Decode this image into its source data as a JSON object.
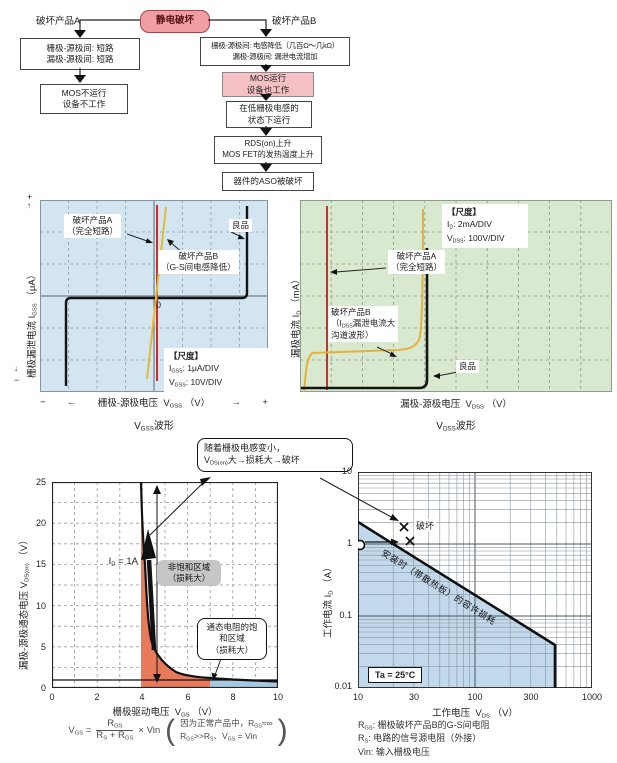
{
  "colors": {
    "panel_blue": "#d2e5f1",
    "panel_green": "#d8e9d0",
    "pink_root": "#f09da4",
    "pink_box": "#f5c0c4",
    "trace_red": "#c9302c",
    "trace_yellow": "#e2bb35",
    "fill_orange": "#e87a5b",
    "fill_blue": "#a6c9e2",
    "aso_blue": "#c2d8eb"
  },
  "fc": {
    "root": "静电破坏",
    "branch_a": "破坏产品A",
    "branch_b": "破坏产品B",
    "a1l1": "栅极-源极间: 短路",
    "a1l2": "漏极-源极间: 短路",
    "a2l1": "MOS不运行",
    "a2l2": "设备不工作",
    "b1l1": "栅极-源极间: 电感降低（几百Ω～几kΩ）",
    "b1l2": "漏极-源极间: 漏泄电流增加",
    "b2l1": "MOS运行",
    "b2l2": "设备也工作",
    "b3l1": "在低栅极电感的",
    "b3l2": "状态下运行",
    "b4l1": "RDS(on)上升",
    "b4l2": "MOS FET的发热温度上升",
    "b5": "器件的ASO被破坏"
  },
  "gss": {
    "plus": "+",
    "minus": "−",
    "up": "↑",
    "down": "↓",
    "larr": "←",
    "rarr": "→",
    "ylabel": "栅极漏泄电流 ",
    "ysym": "I",
    "ysub": "GSS",
    "yunit": "（μA）",
    "label_a1": "破坏产品A",
    "label_a2": "（完全短路）",
    "label_b1": "破坏产品B",
    "label_b2": "（G-S间电感降低）",
    "good": "良品",
    "zero": "0",
    "scale_title": "【尺度】",
    "s1sym": "I",
    "s1sub": "GSS",
    "s1val": ": 1μA/DIV",
    "s2sym": "V",
    "s2sub": "GSS",
    "s2val": ": 10V/DIV",
    "xlabel": "栅极-源极电压",
    "xsym": "V",
    "xsub": "GSS",
    "xunit": "（V）",
    "capsym": "V",
    "capsub": "GSS",
    "captail": "波形"
  },
  "dss": {
    "ylabel": "漏极电流 ",
    "ysym": "I",
    "ysub": "D",
    "yunit": "（mA）",
    "scale_title": "【尺度】",
    "s1sym": "I",
    "s1sub": "D",
    "s1val": ": 2mA/DIV",
    "s2sym": "V",
    "s2sub": "DSS",
    "s2val": ": 100V/DIV",
    "label_a1": "破坏产品A",
    "label_a2": "（完全短路）",
    "label_b1": "破坏产品B",
    "label_b2a": "（I",
    "label_b2sub": "DSS",
    "label_b2b": "漏泄电流大",
    "label_b3": "沟道波形）",
    "good": "良品",
    "xlabel": "漏极-源极电压",
    "xsym": "V",
    "xsub": "DSS",
    "xunit": "（V）",
    "capsym": "V",
    "capsub": "DSS",
    "captail": "波形"
  },
  "callout": {
    "l1": "随着栅极电感变小，",
    "l2a": "V",
    "l2sub": "DS(on)",
    "l2b": "大→损耗大→破坏"
  },
  "vgs": {
    "yticks": [
      "25",
      "20",
      "15",
      "10",
      "5",
      "0"
    ],
    "xticks": [
      "0",
      "2",
      "4",
      "6",
      "8",
      "10"
    ],
    "ylabel": "漏极-源极通态电压 ",
    "ysym": "V",
    "ysub": "DS(on)",
    "yunit": "（V）",
    "xlabel": "栅极驱动电压",
    "xsym": "V",
    "xsub": "GS",
    "xunit": "（V）",
    "id_sym": "I",
    "id_sub": "D",
    "id_val": " = 1A",
    "r1l1": "非饱和区域",
    "r1l2": "（损耗大）",
    "r2l1": "通态电阻的饱",
    "r2l2": "和区域",
    "r2l3": "（损耗大）"
  },
  "aso": {
    "yticks": [
      "10",
      "1",
      "0.1",
      "0.01"
    ],
    "xticks": [
      "10",
      "30",
      "100",
      "300",
      "1000"
    ],
    "ylabel": "工作电流 ",
    "ysym": "I",
    "ysub": "D",
    "yunit": "（A）",
    "xlabel": "工作电压",
    "xsym": "V",
    "xsub": "DS",
    "xunit": "（V）",
    "destroy": "破坏",
    "diag": "安装时（带散热板）的容许损耗",
    "ta": "Ta = 25°C"
  },
  "formula": {
    "lhs": "V",
    "lhs_sub": "GS",
    "eq": "=",
    "num": "R",
    "num_sub": "GS",
    "den_a": "R",
    "den_a_sub": "S",
    "den_plus": " + ",
    "den_b": "R",
    "den_b_sub": "GS",
    "times": "× Vin",
    "pl": "(",
    "pr": ")",
    "n1a": "因为正常产品中，R",
    "n1sub": "GS",
    "n1b": "≈∞",
    "n2a": "R",
    "n2a_sub": "GS",
    "n2b": ">>R",
    "n2b_sub": "S",
    "n2c": "、V",
    "n2c_sub": "GS",
    "n2d": " = Vin"
  },
  "notes": {
    "n1sym": "R",
    "n1sub": "GS",
    "n1txt": ": 栅极破坏产品B的G-S间电阻",
    "n2sym": "R",
    "n2sub": "S",
    "n2txt": ": 电路的信号源电阻（外接）",
    "n3sym": "Vin",
    "n3txt": ": 输入栅极电压"
  },
  "chart_data": [
    {
      "type": "line",
      "title": "VGSS波形",
      "xlabel": "栅极-源极电压 VGSS (V)",
      "ylabel": "栅极漏泄电流 IGSS (μA)",
      "x_scale": "10V/DIV",
      "y_scale": "1μA/DIV",
      "grid": "8x6 dashed divisions, oscilloscope style",
      "series": [
        {
          "name": "破坏产品A（完全短路）",
          "shape": "vertical line at VGSS = 0",
          "color": "#c9302c"
        },
        {
          "name": "破坏产品B（G-S间电感降低）",
          "shape": "steep resistive line through origin",
          "color": "#e2bb35"
        },
        {
          "name": "良品",
          "shape": "zero leakage flat trace with breakdown walls near -35V and +40V",
          "color": "#141414"
        }
      ]
    },
    {
      "type": "line",
      "title": "VDSS波形",
      "xlabel": "漏极-源极电压 VDSS (V)",
      "ylabel": "漏极电流 ID (mA)",
      "x_scale": "100V/DIV",
      "y_scale": "2mA/DIV",
      "grid": "10x6 dashed divisions, oscilloscope style",
      "series": [
        {
          "name": "破坏产品A（完全短路）",
          "shape": "vertical line near VDSS = 0",
          "color": "#c9302c"
        },
        {
          "name": "破坏产品B（IDSS漏泄电流大 沟道波形）",
          "shape": "large leakage knee then breakdown near 400V",
          "color": "#e2bb35"
        },
        {
          "name": "良品",
          "shape": "zero current flat trace, sharp breakdown near 400V",
          "color": "#141414"
        }
      ]
    },
    {
      "type": "line",
      "title": "VDS(on) vs VGS at ID = 1A",
      "xlabel": "栅极驱动电压 VGS (V)",
      "ylabel": "漏极-源极通态电压 VDS(on) (V)",
      "xlim": [
        0,
        10
      ],
      "ylim": [
        0,
        25
      ],
      "condition": "ID = 1A",
      "x": [
        3.95,
        4.1,
        4.3,
        4.6,
        5,
        5.5,
        6,
        7,
        8,
        10
      ],
      "y": [
        25,
        20,
        12,
        6.5,
        4,
        2.5,
        1.8,
        1.2,
        1,
        0.8
      ],
      "regions": [
        {
          "label": "非饱和区域（损耗大）",
          "x_range": [
            3.95,
            7
          ],
          "color": "#e87a5b"
        },
        {
          "label": "通态电阻的饱和区域（损耗大）",
          "x_range": [
            7,
            10
          ],
          "color": "#a6c9e2"
        }
      ]
    },
    {
      "type": "line",
      "title": "ASO 安全工作区",
      "xlabel": "工作电压 VDS (V)",
      "ylabel": "工作电流 ID (A)",
      "xlim": [
        10,
        1000
      ],
      "ylim": [
        0.01,
        10
      ],
      "log_x": true,
      "log_y": true,
      "temperature": "Ta = 25°C",
      "boundary_label": "安装时（带散热板）的容许损耗",
      "boundary": [
        [
          10,
          2
        ],
        [
          480,
          0.04
        ],
        [
          480,
          0.01
        ]
      ],
      "operating_point": [
        10,
        1
      ],
      "failure_points": [
        [
          27,
          1.4
        ],
        [
          30,
          0.95
        ]
      ],
      "failure_label": "破坏"
    }
  ]
}
